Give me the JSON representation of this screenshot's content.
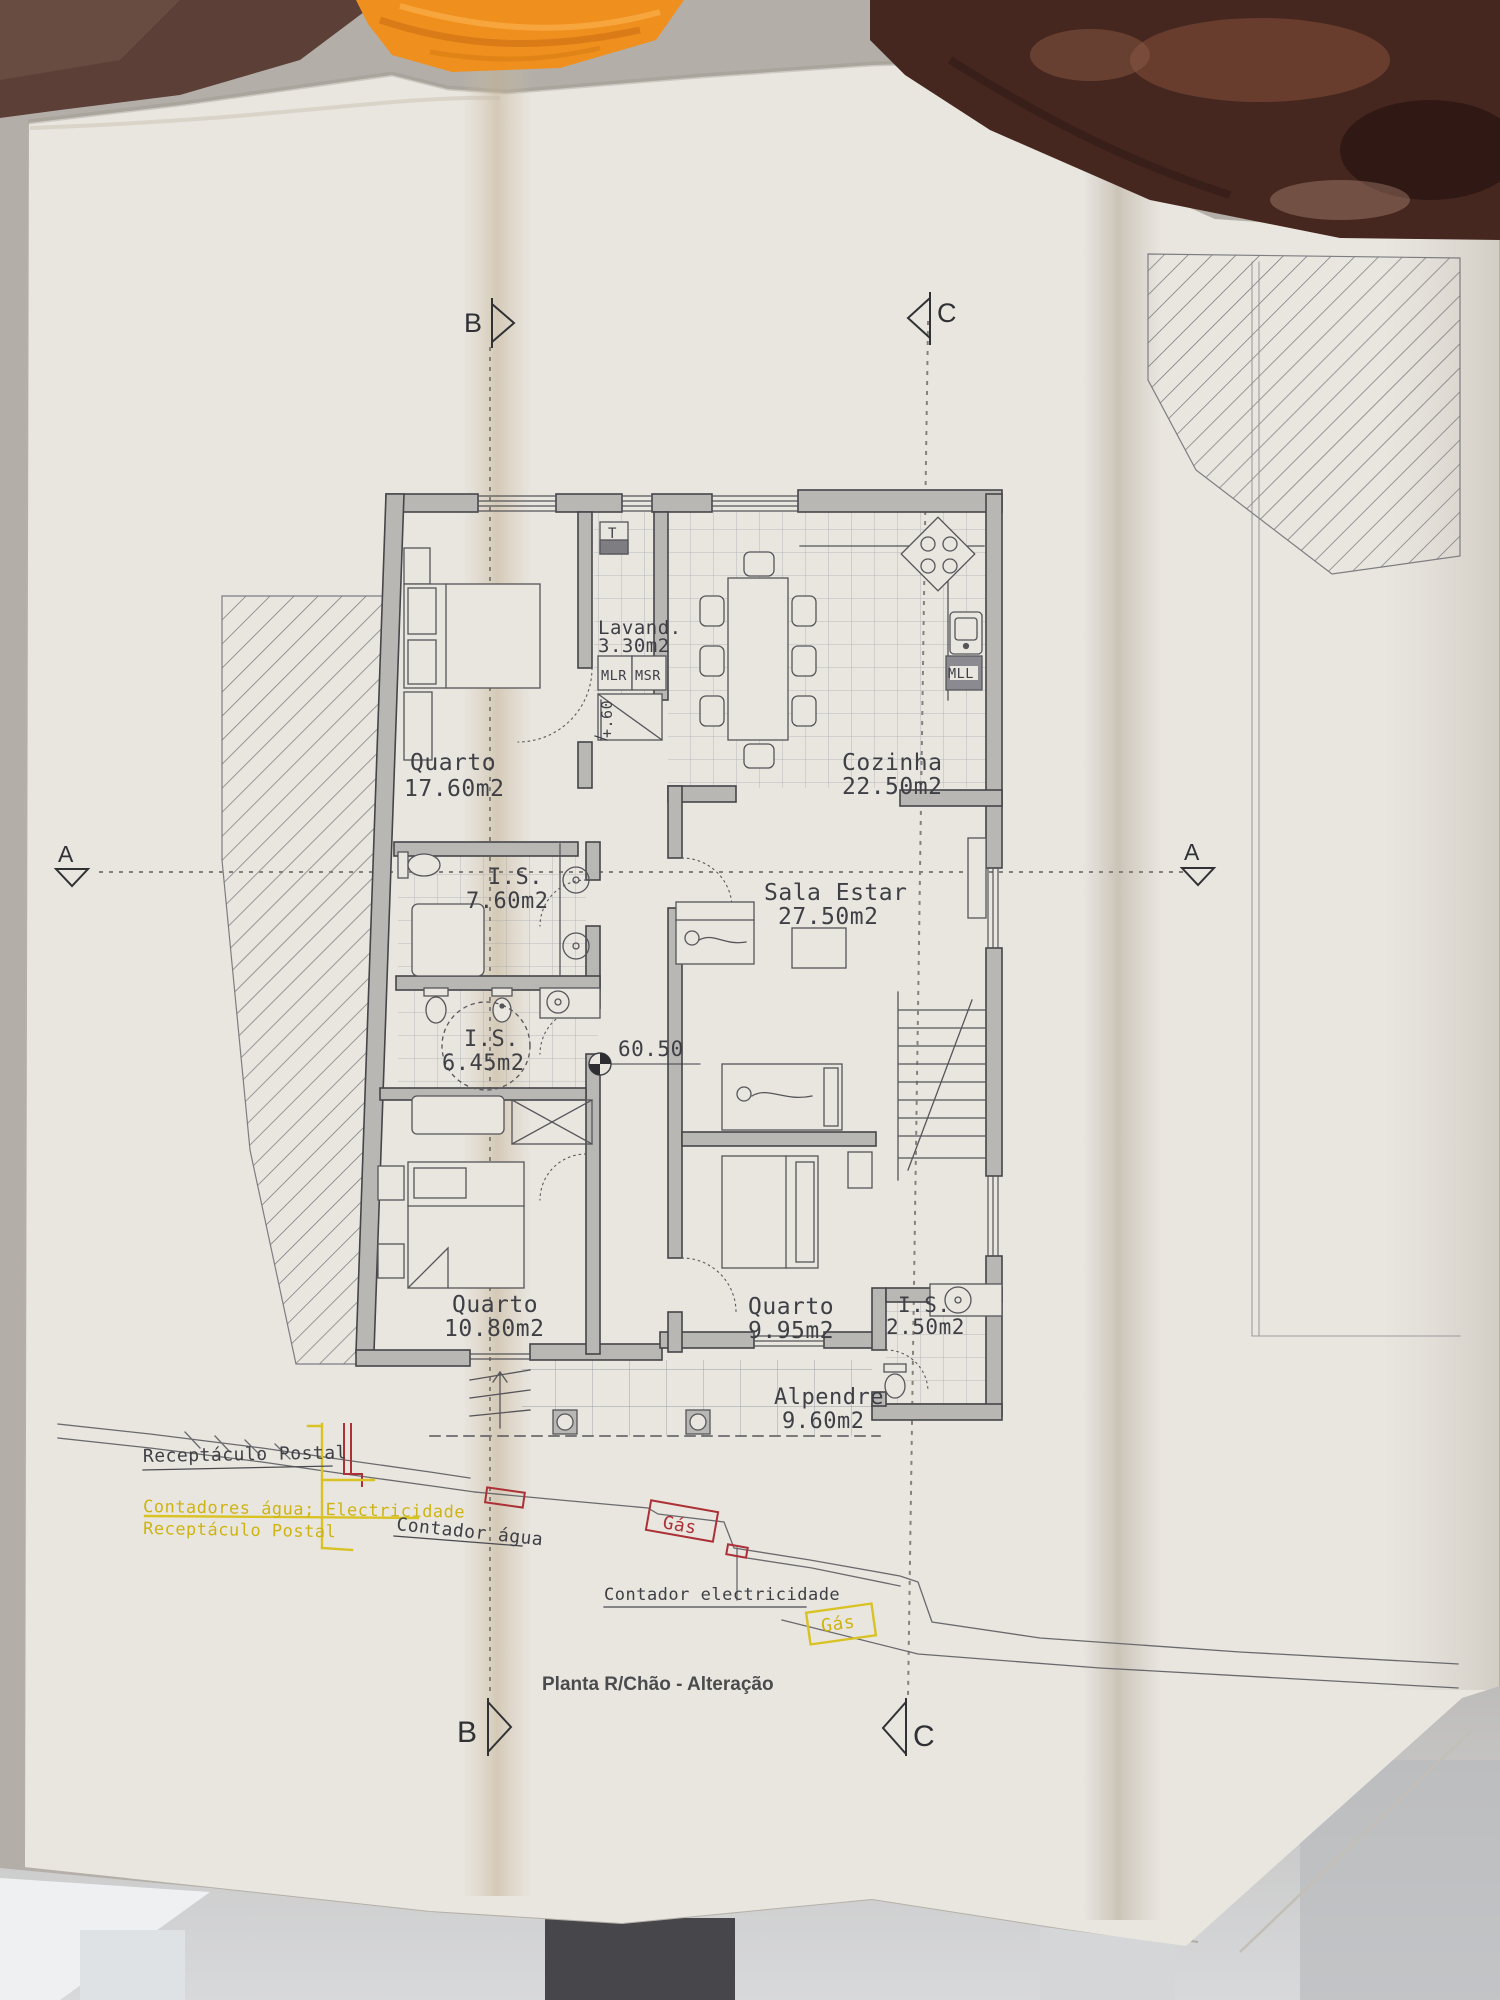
{
  "title": "Planta R/Chão - Alteração",
  "sections": {
    "a": "A",
    "b": "B",
    "c": "C"
  },
  "rooms": [
    {
      "name": "Quarto",
      "area": "17.60m2"
    },
    {
      "name": "Lavand.",
      "area": "3.30m2"
    },
    {
      "name": "Cozinha",
      "area": "22.50m2"
    },
    {
      "name": "I.S.",
      "area": "7.60m2"
    },
    {
      "name": "Sala Estar",
      "area": "27.50m2"
    },
    {
      "name": "I.S.",
      "area": "6.45m2"
    },
    {
      "name": "Quarto",
      "area": "10.80m2"
    },
    {
      "name": "Quarto",
      "area": "9.95m2"
    },
    {
      "name": "I.S.",
      "area": "2.50m2"
    },
    {
      "name": "Alpendre",
      "area": "9.60m2"
    }
  ],
  "appliances": {
    "water_heater": "T",
    "washer": "MLR",
    "dryer": "MSR",
    "dishwasher": "MLL"
  },
  "levels": {
    "floor_level": "60.50",
    "step_height": "+.60"
  },
  "utilities": {
    "postal_box": "Receptáculo Postal",
    "meters_note": "Contadores água; Electricidade",
    "postal_note": "Receptáculo Postal",
    "water_meter": "Contador água",
    "gas_1": "Gás",
    "electric_meter": "Contador electricidade",
    "gas_2": "Gás"
  },
  "colors": {
    "annotation_yellow": "#cdb413",
    "annotation_red": "#ac3136",
    "plan_line": "#4a4a50",
    "wall_fill": "#b9b7b4",
    "towel_orange": "#ef8f1e",
    "background_dark": "#46271f",
    "paper": "#e9e6e0"
  }
}
